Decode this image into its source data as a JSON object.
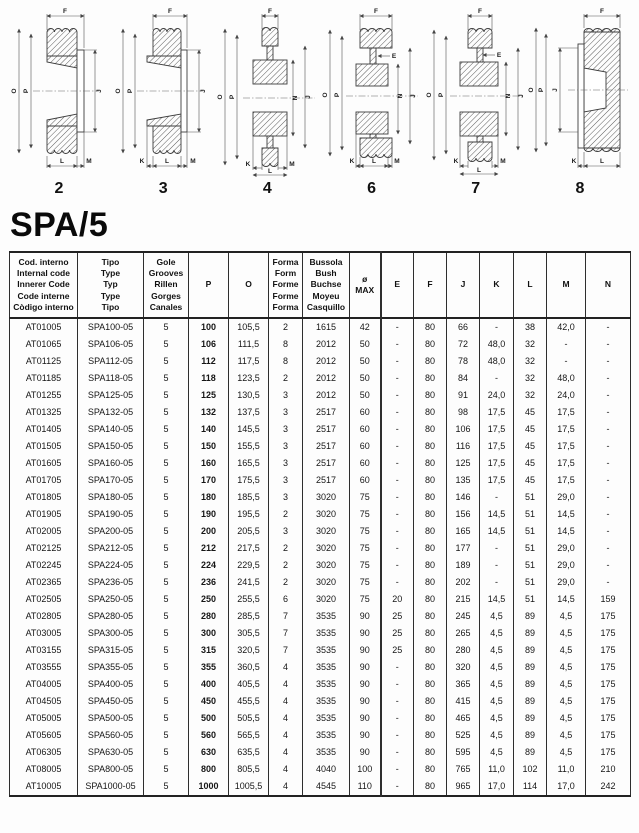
{
  "page": {
    "title": "SPA/5"
  },
  "diagrams": [
    {
      "number": "2",
      "labels": {
        "top": "F",
        "left_outer": "O",
        "left_inner": "P",
        "right_outer": "J",
        "bottom_center": "L",
        "bottom_right": "M"
      }
    },
    {
      "number": "3",
      "labels": {
        "top": "F",
        "left_outer": "O",
        "left_inner": "P",
        "right_outer": "J",
        "bottom_left": "K",
        "bottom_center": "L",
        "bottom_right": "M"
      }
    },
    {
      "number": "4",
      "labels": {
        "top": "F",
        "left_outer": "O",
        "left_inner": "P",
        "right_inner": "N",
        "right_outer": "J",
        "bottom_left": "K",
        "bottom_center": "L",
        "bottom_right": "M"
      }
    },
    {
      "number": "6",
      "labels": {
        "top": "F",
        "hub_step": "E",
        "left_outer": "O",
        "left_inner": "P",
        "right_inner": "N",
        "right_outer": "J",
        "bottom_left": "K",
        "bottom_center": "L",
        "bottom_right": "M"
      }
    },
    {
      "number": "7",
      "labels": {
        "top": "F",
        "hub_step": "E",
        "left_outer": "O",
        "left_inner": "P",
        "right_inner": "N",
        "right_outer": "J",
        "bottom_left": "K",
        "bottom_center": "L",
        "bottom_right": "M"
      }
    },
    {
      "number": "8",
      "labels": {
        "top": "F",
        "left_outer": "O",
        "left_inner": "P",
        "right_inner": "J",
        "bottom_left": "K",
        "bottom_center": "L"
      }
    }
  ],
  "table": {
    "headers": {
      "code": "Cod. interno\nInternal code\nInnerer Code\nCode interne\nCòdigo interno",
      "type": "Tipo\nType\nTyp\nType\nTipo",
      "grooves": "Gole\nGrooves\nRillen\nGorges\nCanales",
      "p": "P",
      "o": "O",
      "form": "Forma\nForm\nForme\nForme\nForma",
      "bush": "Bussola\nBush\nBuchse\nMoyeu\nCasquillo",
      "dmax": "ø\nMAX",
      "e": "E",
      "f": "F",
      "j": "J",
      "k": "K",
      "l": "L",
      "m": "M",
      "n": "N"
    },
    "rows": [
      [
        "AT01005",
        "SPA100-05",
        "5",
        "100",
        "105,5",
        "2",
        "1615",
        "42",
        "-",
        "80",
        "66",
        "-",
        "38",
        "42,0",
        "-"
      ],
      [
        "AT01065",
        "SPA106-05",
        "5",
        "106",
        "111,5",
        "8",
        "2012",
        "50",
        "-",
        "80",
        "72",
        "48,0",
        "32",
        "-",
        "-"
      ],
      [
        "AT01125",
        "SPA112-05",
        "5",
        "112",
        "117,5",
        "8",
        "2012",
        "50",
        "-",
        "80",
        "78",
        "48,0",
        "32",
        "-",
        "-"
      ],
      [
        "AT01185",
        "SPA118-05",
        "5",
        "118",
        "123,5",
        "2",
        "2012",
        "50",
        "-",
        "80",
        "84",
        "-",
        "32",
        "48,0",
        "-"
      ],
      [
        "AT01255",
        "SPA125-05",
        "5",
        "125",
        "130,5",
        "3",
        "2012",
        "50",
        "-",
        "80",
        "91",
        "24,0",
        "32",
        "24,0",
        "-"
      ],
      [
        "AT01325",
        "SPA132-05",
        "5",
        "132",
        "137,5",
        "3",
        "2517",
        "60",
        "-",
        "80",
        "98",
        "17,5",
        "45",
        "17,5",
        "-"
      ],
      [
        "AT01405",
        "SPA140-05",
        "5",
        "140",
        "145,5",
        "3",
        "2517",
        "60",
        "-",
        "80",
        "106",
        "17,5",
        "45",
        "17,5",
        "-"
      ],
      [
        "AT01505",
        "SPA150-05",
        "5",
        "150",
        "155,5",
        "3",
        "2517",
        "60",
        "-",
        "80",
        "116",
        "17,5",
        "45",
        "17,5",
        "-"
      ],
      [
        "AT01605",
        "SPA160-05",
        "5",
        "160",
        "165,5",
        "3",
        "2517",
        "60",
        "-",
        "80",
        "125",
        "17,5",
        "45",
        "17,5",
        "-"
      ],
      [
        "AT01705",
        "SPA170-05",
        "5",
        "170",
        "175,5",
        "3",
        "2517",
        "60",
        "-",
        "80",
        "135",
        "17,5",
        "45",
        "17,5",
        "-"
      ],
      [
        "AT01805",
        "SPA180-05",
        "5",
        "180",
        "185,5",
        "3",
        "3020",
        "75",
        "-",
        "80",
        "146",
        "-",
        "51",
        "29,0",
        "-"
      ],
      [
        "AT01905",
        "SPA190-05",
        "5",
        "190",
        "195,5",
        "2",
        "3020",
        "75",
        "-",
        "80",
        "156",
        "14,5",
        "51",
        "14,5",
        "-"
      ],
      [
        "AT02005",
        "SPA200-05",
        "5",
        "200",
        "205,5",
        "3",
        "3020",
        "75",
        "-",
        "80",
        "165",
        "14,5",
        "51",
        "14,5",
        "-"
      ],
      [
        "AT02125",
        "SPA212-05",
        "5",
        "212",
        "217,5",
        "2",
        "3020",
        "75",
        "-",
        "80",
        "177",
        "-",
        "51",
        "29,0",
        "-"
      ],
      [
        "AT02245",
        "SPA224-05",
        "5",
        "224",
        "229,5",
        "2",
        "3020",
        "75",
        "-",
        "80",
        "189",
        "-",
        "51",
        "29,0",
        "-"
      ],
      [
        "AT02365",
        "SPA236-05",
        "5",
        "236",
        "241,5",
        "2",
        "3020",
        "75",
        "-",
        "80",
        "202",
        "-",
        "51",
        "29,0",
        "-"
      ],
      [
        "AT02505",
        "SPA250-05",
        "5",
        "250",
        "255,5",
        "6",
        "3020",
        "75",
        "20",
        "80",
        "215",
        "14,5",
        "51",
        "14,5",
        "159"
      ],
      [
        "AT02805",
        "SPA280-05",
        "5",
        "280",
        "285,5",
        "7",
        "3535",
        "90",
        "25",
        "80",
        "245",
        "4,5",
        "89",
        "4,5",
        "175"
      ],
      [
        "AT03005",
        "SPA300-05",
        "5",
        "300",
        "305,5",
        "7",
        "3535",
        "90",
        "25",
        "80",
        "265",
        "4,5",
        "89",
        "4,5",
        "175"
      ],
      [
        "AT03155",
        "SPA315-05",
        "5",
        "315",
        "320,5",
        "7",
        "3535",
        "90",
        "25",
        "80",
        "280",
        "4,5",
        "89",
        "4,5",
        "175"
      ],
      [
        "AT03555",
        "SPA355-05",
        "5",
        "355",
        "360,5",
        "4",
        "3535",
        "90",
        "-",
        "80",
        "320",
        "4,5",
        "89",
        "4,5",
        "175"
      ],
      [
        "AT04005",
        "SPA400-05",
        "5",
        "400",
        "405,5",
        "4",
        "3535",
        "90",
        "-",
        "80",
        "365",
        "4,5",
        "89",
        "4,5",
        "175"
      ],
      [
        "AT04505",
        "SPA450-05",
        "5",
        "450",
        "455,5",
        "4",
        "3535",
        "90",
        "-",
        "80",
        "415",
        "4,5",
        "89",
        "4,5",
        "175"
      ],
      [
        "AT05005",
        "SPA500-05",
        "5",
        "500",
        "505,5",
        "4",
        "3535",
        "90",
        "-",
        "80",
        "465",
        "4,5",
        "89",
        "4,5",
        "175"
      ],
      [
        "AT05605",
        "SPA560-05",
        "5",
        "560",
        "565,5",
        "4",
        "3535",
        "90",
        "-",
        "80",
        "525",
        "4,5",
        "89",
        "4,5",
        "175"
      ],
      [
        "AT06305",
        "SPA630-05",
        "5",
        "630",
        "635,5",
        "4",
        "3535",
        "90",
        "-",
        "80",
        "595",
        "4,5",
        "89",
        "4,5",
        "175"
      ],
      [
        "AT08005",
        "SPA800-05",
        "5",
        "800",
        "805,5",
        "4",
        "4040",
        "100",
        "-",
        "80",
        "765",
        "11,0",
        "102",
        "11,0",
        "210"
      ],
      [
        "AT10005",
        "SPA1000-05",
        "5",
        "1000",
        "1005,5",
        "4",
        "4545",
        "110",
        "-",
        "80",
        "965",
        "17,0",
        "114",
        "17,0",
        "242"
      ]
    ]
  }
}
